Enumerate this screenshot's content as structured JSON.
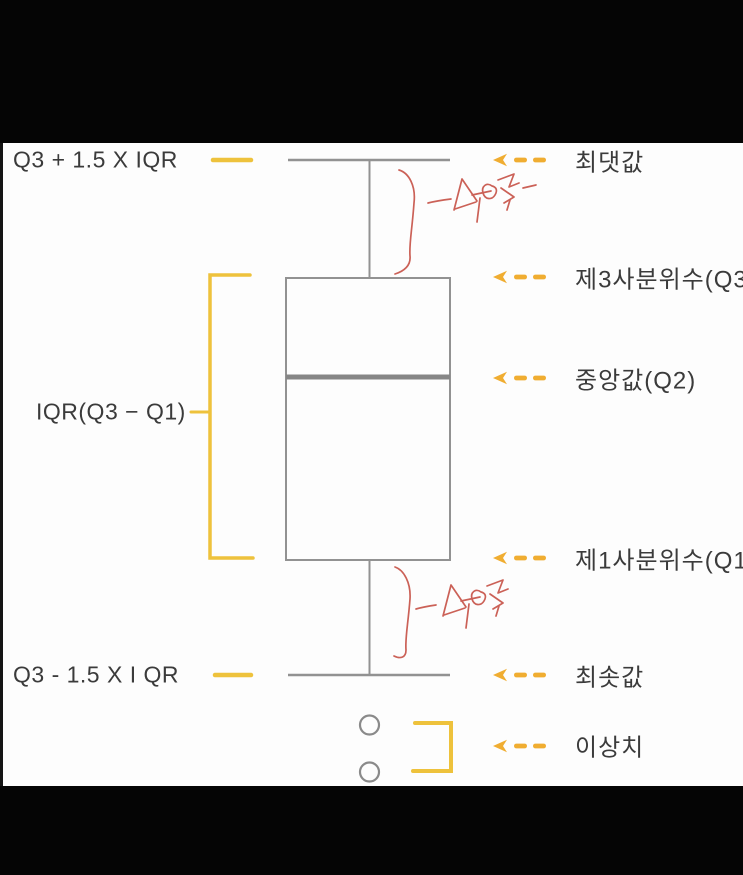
{
  "colors": {
    "background": "#fdfdfd",
    "letterbox": "#050505",
    "gold_marks": "#eec23c",
    "gold_arrows": "#f0ad31",
    "plot_line_gray": "#929292",
    "median_gray": "#868686",
    "label_text": "#3b3b3b",
    "handwriting_red": "#cb6157"
  },
  "diagram": {
    "type": "boxplot-anatomy",
    "left_labels": {
      "upper_fence": "Q3 + 1.5 X IQR",
      "iqr": "IQR(Q3 − Q1)",
      "lower_fence": "Q3 - 1.5 X I QR"
    },
    "right_labels": {
      "max": "최댓값",
      "q3": "제3사분위수(Q3)",
      "median": "중앙값(Q2)",
      "q1": "제1사분위수(Q1)",
      "min": "최솟값",
      "outliers": "이상치"
    },
    "handwritten_annotations": [
      {
        "text": "수염",
        "location": "upper-whisker"
      },
      {
        "text": "수염",
        "location": "lower-whisker"
      }
    ],
    "outlier_points": 2
  }
}
